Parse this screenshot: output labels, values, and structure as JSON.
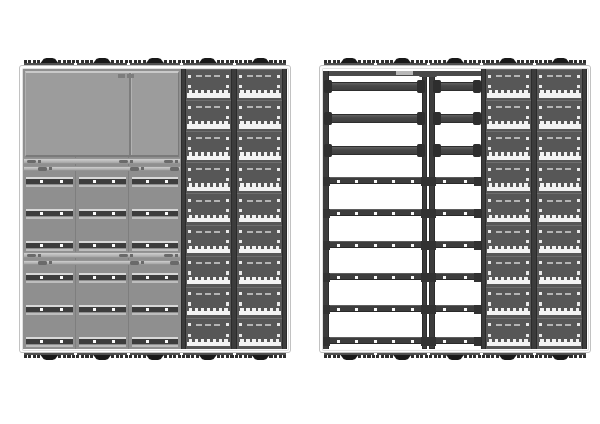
{
  "canvas": {
    "width": 600,
    "height": 424,
    "background": "#ffffff"
  },
  "illustration": {
    "subject": "rear-view-cabinet-assemblies",
    "assembly_count": 2,
    "feet_groups_per_edge": 5,
    "foot_pads_per_side": 4,
    "perforated_modules_per_column": 9,
    "perforated_columns_per_assembly": 2,
    "rail_rows_per_assembly": 6,
    "cross_beams_right_assembly": 3,
    "rail_strips_per_row_left_assembly": 3,
    "comb_teeth_per_vent_strip": 7
  },
  "colors": {
    "frame_border": "#c2c2c2",
    "frame_fill": "#fdfdfd",
    "frame_inner_line": "#e0e0e0",
    "panel_gray": "#8f8f8f",
    "column_seam": "#7e7e7e",
    "block_fill": "#9c9c9c",
    "block_top_edge": "#c9c9c9",
    "block_side_light": "#b0b0b0",
    "block_side_dark": "#7a7a7a",
    "block_seam_dark": "#7d7d7d",
    "block_seam_light": "#b2b2b2",
    "clip_fill": "#6a6a6a",
    "seam_bar_light": "#cfcfcf",
    "seam_bar_dark": "#a6a6a6",
    "seam_bar_border": "#949494",
    "rail_dark": "#3d3d3d",
    "rail_top_edge": "#d8d8d8",
    "rail_bottom_edge": "#bdbdbd",
    "rail_dot": "#fafafa",
    "rail_hi": "#5f5f5f",
    "rail_lo": "#292929",
    "rail_coupler": "#323232",
    "beam_hi": "#616161",
    "beam_mid": "#484848",
    "beam_lo": "#3e3e3e",
    "beam_border": "#2e2e2e",
    "coupler": "#2e2e2e",
    "post_fill": "#3c3c3c",
    "post_border": "#2b2b2b",
    "post_cap": "#4a4a4a",
    "topbar_fill": "#4a4a4a",
    "topbar_plate": "#b8b8b8",
    "perf_bg": "#4a4a4a",
    "module_bg": "#575757",
    "module_edge": "#6e6e6e",
    "module_square": "#e9e9e9",
    "module_dash": "#b5b5b5",
    "comb_fill": "#f3f3f3",
    "foot_dark": "#191919",
    "foot_mid": "#2e2e2e",
    "foot_base": "#4f4f4f",
    "open_bay": "#ffffff"
  },
  "layout": {
    "frame_y": 65,
    "frame_w": 272,
    "frame_h": 288,
    "inset": 4,
    "columns_per_panel": 5,
    "col_w": 52.8,
    "inner_w": 264,
    "inner_h": 280,
    "gray_zone_w": 158.4,
    "perf_zone_x": 158.4,
    "perf_zone_w": 105.6,
    "module_h": 31.1,
    "rail_rows_y": [
      108,
      140,
      172,
      204,
      236,
      268
    ],
    "beam_rows_y": [
      13,
      45,
      77
    ],
    "block": {
      "x": 2,
      "y": 2,
      "w": 154,
      "h": 86,
      "seam_x": 103
    },
    "seam_bar_pairs_y": [
      [
        89,
        96.5
      ],
      [
        183,
        190.5
      ]
    ],
    "feet_h": 10,
    "foot_w": 50
  },
  "assemblies": [
    {
      "name": "left",
      "x": 19,
      "style": "panelled",
      "has_back_block": true,
      "cabinet_seams": 2
    },
    {
      "name": "right",
      "x": 319,
      "style": "open-frame",
      "has_top_bar": true,
      "cabinet_seams": 0
    }
  ]
}
